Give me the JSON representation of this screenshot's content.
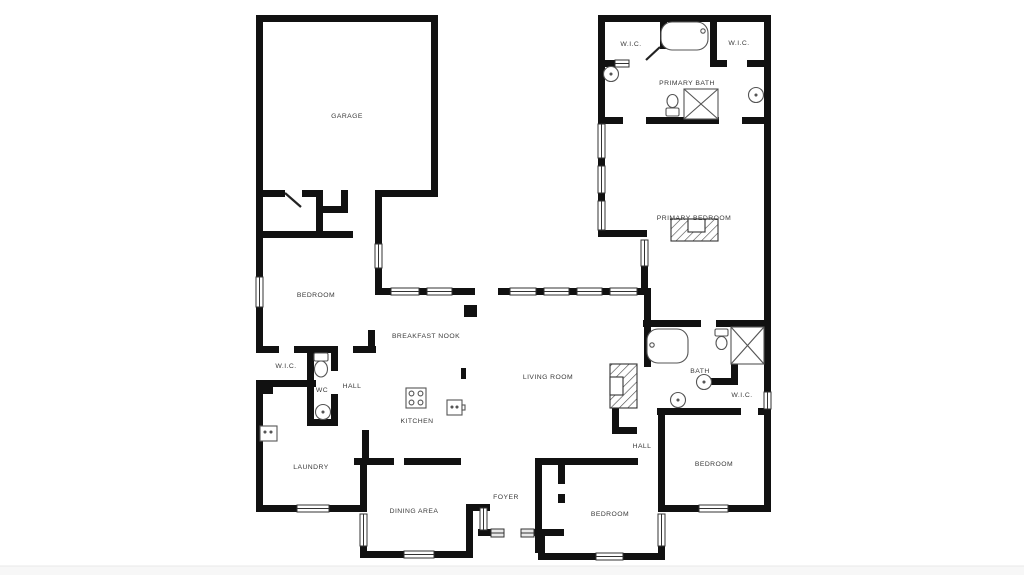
{
  "plan": {
    "type": "residential floor plan",
    "colors": {
      "background": "#ffffff",
      "walls": "#111111",
      "fixture_stroke": "#555555",
      "footer_strip": "#f7f7f7"
    },
    "rooms": [
      {
        "name": "garage",
        "label": "GARAGE"
      },
      {
        "name": "bedroom-left",
        "label": "BEDROOM"
      },
      {
        "name": "wic-left",
        "label": "W.I.C."
      },
      {
        "name": "wc",
        "label": "WC"
      },
      {
        "name": "hall-left",
        "label": "HALL"
      },
      {
        "name": "breakfast-nook",
        "label": "BREAKFAST NOOK"
      },
      {
        "name": "kitchen",
        "label": "KITCHEN"
      },
      {
        "name": "laundry",
        "label": "LAUNDRY"
      },
      {
        "name": "living-room",
        "label": "LIVING ROOM"
      },
      {
        "name": "dining-area",
        "label": "DINING AREA"
      },
      {
        "name": "foyer",
        "label": "FOYER"
      },
      {
        "name": "bedroom-bottom",
        "label": "BEDROOM"
      },
      {
        "name": "hall-right",
        "label": "HALL"
      },
      {
        "name": "bedroom-right",
        "label": "BEDROOM"
      },
      {
        "name": "bath",
        "label": "BATH"
      },
      {
        "name": "wic-right",
        "label": "W.I.C."
      },
      {
        "name": "primary-bedroom",
        "label": "PRIMARY BEDROOM"
      },
      {
        "name": "primary-bath",
        "label": "PRIMARY BATH"
      },
      {
        "name": "wic-primary-left",
        "label": "W.I.C."
      },
      {
        "name": "wic-primary-right",
        "label": "W.I.C."
      }
    ],
    "fixtures": [
      "bathtub-icon",
      "shower-icon",
      "toilet-icon",
      "round-sink-icon",
      "cooktop-icon",
      "kitchen-sink-icon",
      "washer-icon",
      "fireplace-icon",
      "window-icon",
      "door-leaf-icon",
      "column-icon"
    ]
  }
}
